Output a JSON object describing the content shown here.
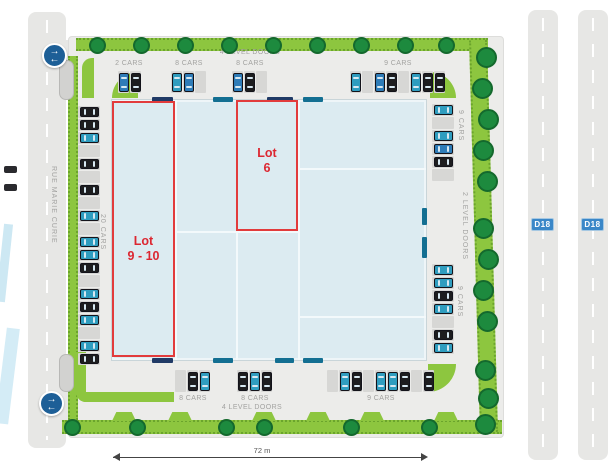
{
  "plan": {
    "streets": {
      "left_street_name": "RUE MARIE CURIE",
      "right_road_badge_1": "D18",
      "right_road_badge_2": "D18"
    },
    "dimension": {
      "width_label": "72 m"
    },
    "doors": {
      "top_label": "4 LEVEL DOORS",
      "bottom_label": "4 LEVEL DOORS",
      "right_label": "2 LEVEL DOORS"
    },
    "lots": {
      "lot_9_10": {
        "line1": "Lot",
        "line2": "9 - 10"
      },
      "lot_6": {
        "line1": "Lot",
        "line2": "6"
      }
    },
    "parking": {
      "top": {
        "groups": [
          {
            "label": "2 CARS",
            "stalls": [
              "blue",
              "black"
            ]
          },
          {
            "label": "8 CARS",
            "stalls": [
              "teal",
              "blue",
              "empty"
            ]
          },
          {
            "label": "8 CARS",
            "stalls": [
              "blue",
              "black",
              "empty"
            ]
          },
          {
            "label": "9 CARS",
            "stalls": [
              "teal",
              "empty",
              "blue",
              "black",
              "empty",
              "teal",
              "black",
              "black"
            ]
          }
        ]
      },
      "bottom": {
        "groups": [
          {
            "label": "8 CARS",
            "stalls": [
              "empty",
              "black",
              "teal"
            ]
          },
          {
            "label": "8 CARS",
            "stalls": [
              "black",
              "teal",
              "black"
            ]
          },
          {
            "label": "9 CARS",
            "stalls": [
              "empty",
              "teal",
              "black",
              "empty",
              "teal",
              "teal",
              "black",
              "empty",
              "black"
            ]
          }
        ]
      },
      "left": {
        "label": "20 CARS",
        "stalls": [
          "black",
          "black",
          "teal",
          "empty",
          "black",
          "empty",
          "black",
          "empty",
          "teal",
          "empty",
          "teal",
          "teal",
          "black",
          "empty",
          "teal",
          "black",
          "teal",
          "empty",
          "teal",
          "black"
        ]
      },
      "right": {
        "top_label": "9 CARS",
        "bottom_label": "9 CARS",
        "top_stalls": [
          "teal",
          "empty",
          "teal",
          "blue",
          "black",
          "empty"
        ],
        "bottom_stalls": [
          "teal",
          "teal",
          "black",
          "teal",
          "empty",
          "black",
          "teal"
        ]
      }
    },
    "icons": {
      "traffic_icon": "two-way-traffic-arrows",
      "tree_icon": "tree",
      "car_icon": "car",
      "road_badge_icon": "route-number-shield"
    },
    "colors": {
      "landscape_green": "#8dc63f",
      "tree_green": "#1d8a3e",
      "building_fill": "#dcebf1",
      "lot_outline_red": "#e23b3c",
      "lot_text_red": "#dc2731",
      "door_teal": "#136f92",
      "door_navy": "#203a66",
      "car_blue": "#2e7cb8",
      "car_teal": "#2f9dbf",
      "car_black": "#1d1d1f",
      "road_grey": "#e7e7e5",
      "badge_blue": "#3a87c8"
    }
  }
}
